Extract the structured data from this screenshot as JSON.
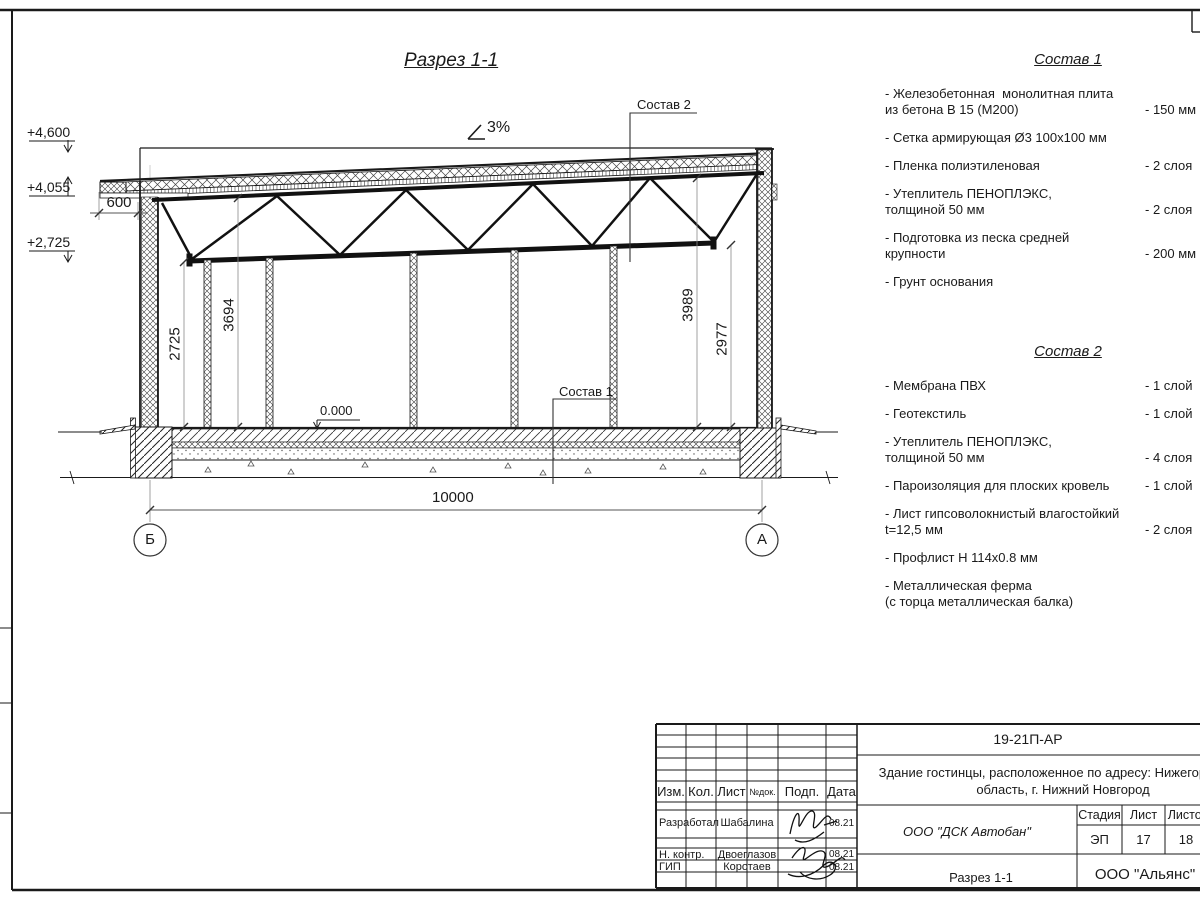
{
  "drawing": {
    "title": "Разрез 1-1",
    "slope": "3%",
    "zero_level": "0.000",
    "elev_top": "+4,600",
    "elev_eave": "+4,055",
    "elev_truss": "+2,725",
    "dim_overhang": "600",
    "dim_h_left": "2725",
    "dim_h_left2": "3694",
    "dim_h_right2": "3989",
    "dim_h_right": "2977",
    "dim_span": "10000",
    "axis_left": "Б",
    "axis_right": "А",
    "leader1": "Состав 1",
    "leader2": "Состав 2"
  },
  "sostav1": {
    "title": "Состав 1",
    "items": [
      {
        "name": "- Железобетонная  монолитная плита\nиз бетона В 15 (М200)",
        "value": "- 150 мм"
      },
      {
        "name": "- Сетка армирующая Ø3 100х100 мм",
        "value": ""
      },
      {
        "name": "- Пленка полиэтиленовая",
        "value": "-  2 слоя"
      },
      {
        "name": "- Утеплитель ПЕНОПЛЭКС,\nтолщиной 50 мм",
        "value": "- 2 слоя"
      },
      {
        "name": "- Подготовка из песка средней\nкрупности",
        "value": "- 200 мм"
      },
      {
        "name": "- Грунт основания",
        "value": ""
      }
    ]
  },
  "sostav2": {
    "title": "Состав 2",
    "items": [
      {
        "name": "- Мембрана ПВХ",
        "value": "- 1 слой"
      },
      {
        "name": "- Геотекстиль",
        "value": "- 1 слой"
      },
      {
        "name": "- Утеплитель ПЕНОПЛЭКС,\nтолщиной 50 мм",
        "value": "- 4 слоя"
      },
      {
        "name": "- Пароизоляция для плоских кровель",
        "value": "- 1 слой"
      },
      {
        "name": "- Лист гипсоволокнистый влагостойкий\nt=12,5 мм",
        "value": "- 2 слоя"
      },
      {
        "name": "- Профлист Н 114х0.8 мм",
        "value": ""
      },
      {
        "name": "- Металлическая ферма\n(с торца металлическая балка)",
        "value": ""
      }
    ]
  },
  "titleblock": {
    "code": "19-21П-АР",
    "object_line1": "Здание гостинцы, расположенное по адресу: Нижегородская",
    "object_line2": "область, г. Нижний Новгород",
    "col_izm": "Изм.",
    "col_kol": "Кол.",
    "col_list": "Лист",
    "col_ndok": "№док.",
    "col_podp": "Подп.",
    "col_data": "Дата",
    "row1_role": "Разработал",
    "row1_name": "Шабалина",
    "row1_date": "08.21",
    "row2_role": "Н. контр.",
    "row2_name": "Двоеглазов",
    "row2_date": "08.21",
    "row3_role": "ГИП",
    "row3_name": "Коротаев",
    "row3_date": "08.21",
    "org": "ООО \"ДСК Автобан\"",
    "stage_label": "Стадия",
    "sheet_label": "Лист",
    "sheets_label": "Листов",
    "stage_value": "ЭП",
    "sheet_value": "17",
    "sheets_value": "18",
    "view_name": "Разрез 1-1",
    "company": "ООО \"Альянс\""
  }
}
